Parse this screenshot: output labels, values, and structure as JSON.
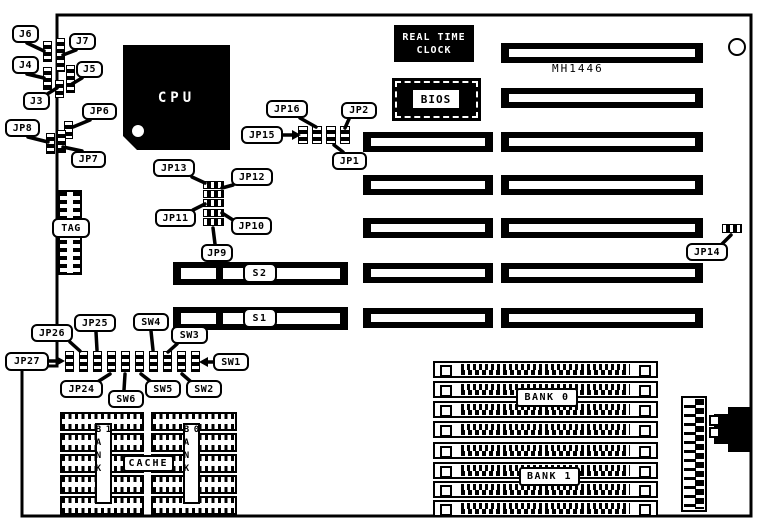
{
  "board": {
    "model": "MH1446"
  },
  "chips": {
    "cpu": "CPU",
    "rtc": "REAL TIME CLOCK",
    "bios": "BIOS",
    "tag": "TAG",
    "cache": "CACHE",
    "cache_bank_left": "BANK 1",
    "cache_bank_right": "BANK 0"
  },
  "slots": {
    "s1": "S1",
    "s2": "S2"
  },
  "memory": {
    "bank0": "BANK 0",
    "bank1": "BANK 1"
  },
  "jumpers": {
    "j3": "J3",
    "j4": "J4",
    "j5": "J5",
    "j6": "J6",
    "j7": "J7",
    "jp1": "JP1",
    "jp2": "JP2",
    "jp6": "JP6",
    "jp7": "JP7",
    "jp8": "JP8",
    "jp9": "JP9",
    "jp10": "JP10",
    "jp11": "JP11",
    "jp12": "JP12",
    "jp13": "JP13",
    "jp14": "JP14",
    "jp15": "JP15",
    "jp16": "JP16",
    "jp24": "JP24",
    "jp25": "JP25",
    "jp26": "JP26",
    "jp27": "JP27",
    "sw1": "SW1",
    "sw2": "SW2",
    "sw3": "SW3",
    "sw4": "SW4",
    "sw5": "SW5",
    "sw6": "SW6"
  }
}
